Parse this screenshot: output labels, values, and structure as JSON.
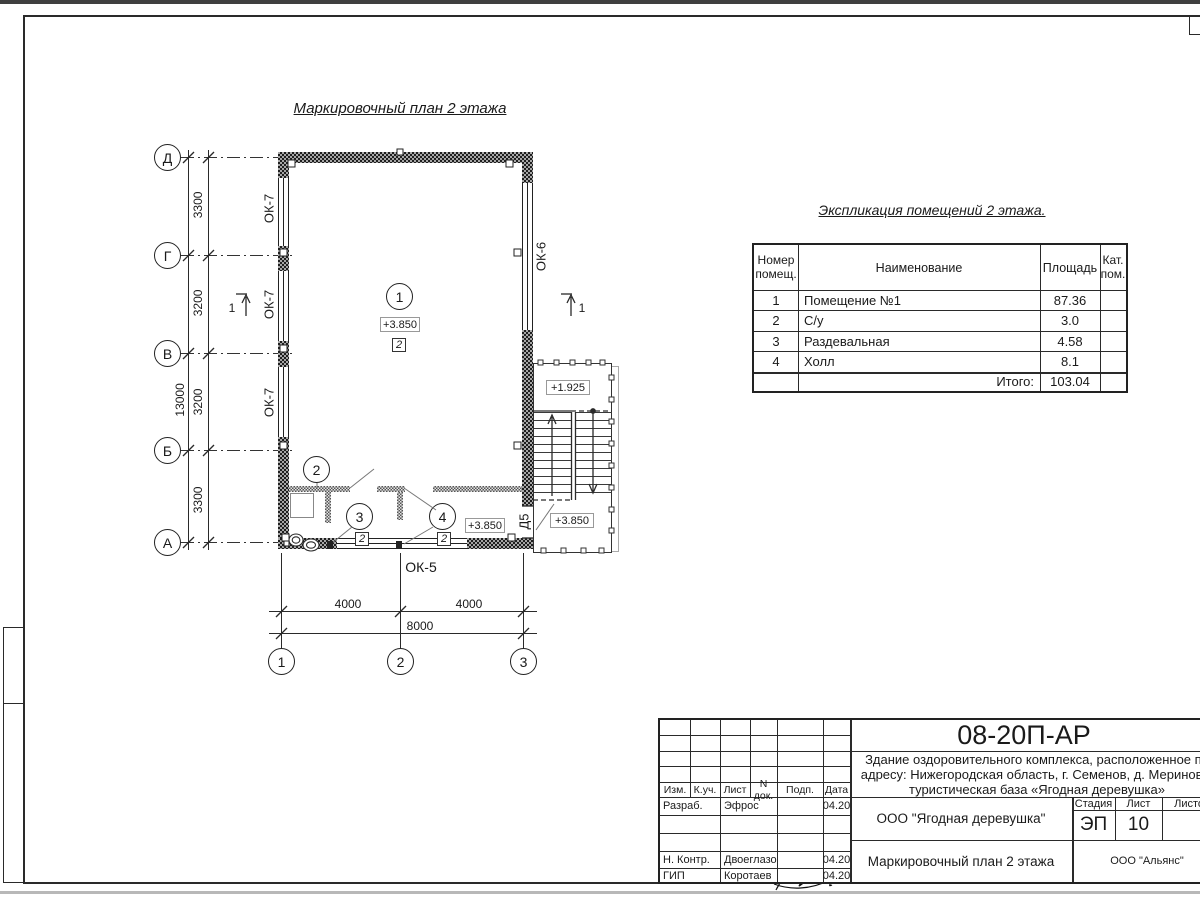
{
  "plan": {
    "title": "Маркировочный план 2 этажа",
    "axes_left": [
      "Д",
      "Г",
      "В",
      "Б",
      "А"
    ],
    "axes_bottom": [
      "1",
      "2",
      "3"
    ],
    "dims_left": [
      "3300",
      "3200",
      "3200",
      "3300"
    ],
    "dim_left_total": "13000",
    "dims_bottom": [
      "4000",
      "4000"
    ],
    "dim_bottom_total": "8000",
    "windows_left": [
      "ОК-7",
      "ОК-7",
      "ОК-7"
    ],
    "window_right": "ОК-6",
    "window_bottom": "ОК-5",
    "door": "Д5",
    "sections": [
      "1",
      "1"
    ],
    "room_numbers": [
      "1",
      "2",
      "3",
      "4"
    ],
    "finish_marks": [
      "2",
      "2",
      "2"
    ],
    "elev_main": "+3.850",
    "elev_hall": "+3.850",
    "elev_stair_upper": "+1.925",
    "elev_stair_lower": "+3.850"
  },
  "explication": {
    "title": "Экспликация помещений 2 этажа.",
    "headers": [
      "Номер\nпомещ.",
      "Наименование",
      "Площадь",
      "Кат.\nпом."
    ],
    "rows": [
      [
        "1",
        "Помещение №1",
        "87.36"
      ],
      [
        "2",
        "С/у",
        "3.0"
      ],
      [
        "3",
        "Раздевальная",
        "4.58"
      ],
      [
        "4",
        "Холл",
        "8.1"
      ]
    ],
    "total_label": "Итого:",
    "total_value": "103.04"
  },
  "titleblock": {
    "doc_number": "08-20П-АР",
    "description": [
      "Здание оздоровительного комплекса, расположенное по",
      "адресу: Нижегородская область, г. Семенов, д. Мериново,",
      "туристическая база «Ягодная деревушка»"
    ],
    "cols": [
      "Изм.",
      "К.уч.",
      "Лист",
      "N док.",
      "Подп.",
      "Дата"
    ],
    "rows": [
      {
        "role": "Разраб.",
        "name": "Эфрос",
        "date": "04.20"
      },
      {
        "role": "Н. Контр.",
        "name": "Двоеглазов",
        "date": "04.20"
      },
      {
        "role": "ГИП",
        "name": "Коротаев",
        "date": "04.20"
      }
    ],
    "client": "ООО \"Ягодная деревушка\"",
    "stage_label": "Стадия",
    "sheet_label": "Лист",
    "sheets_label": "Листов",
    "stage": "ЭП",
    "sheet": "10",
    "sheet_title": "Маркировочный план 2 этажа",
    "company": "ООО \"Альянс\""
  }
}
